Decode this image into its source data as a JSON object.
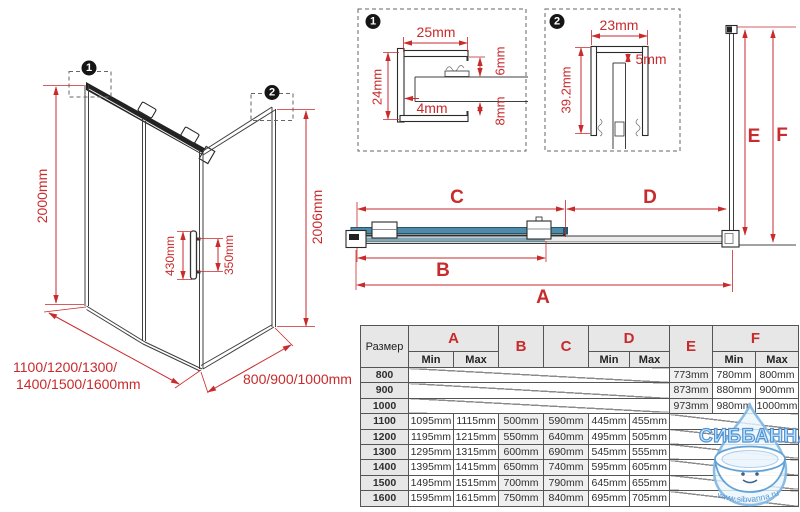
{
  "drawing": {
    "badge1": "1",
    "badge2": "2",
    "dim_height_left": "2000mm",
    "dim_handle_left": "430mm",
    "dim_handle_right": "350mm",
    "dim_height_right": "2006mm",
    "dim_width_front_line1": "1100/1200/1300/",
    "dim_width_front_line2": "1400/1500/1600mm",
    "dim_width_side": "800/900/1000mm"
  },
  "detail1": {
    "badge": "1",
    "dim_top": "25mm",
    "dim_left": "24mm",
    "dim_inner": "4mm",
    "dim_right_top": "6mm",
    "dim_right_bottom": "8mm"
  },
  "detail2": {
    "badge": "2",
    "dim_top": "23mm",
    "dim_gap": "5mm",
    "dim_left": "39.2mm"
  },
  "plan": {
    "label_a": "A",
    "label_b": "B",
    "label_c": "C",
    "label_d": "D",
    "label_e": "E",
    "label_f": "F"
  },
  "table": {
    "size_header": "Размер",
    "min_label": "Min",
    "max_label": "Max",
    "col_a": "A",
    "col_b": "B",
    "col_c": "C",
    "col_d": "D",
    "col_e": "E",
    "col_f": "F",
    "rows": [
      {
        "size": "800",
        "e": "773mm",
        "f_min": "780mm",
        "f_max": "800mm"
      },
      {
        "size": "900",
        "e": "873mm",
        "f_min": "880mm",
        "f_max": "900mm"
      },
      {
        "size": "1000",
        "e": "973mm",
        "f_min": "980mm",
        "f_max": "1000mm"
      },
      {
        "size": "1100",
        "a_min": "1095mm",
        "a_max": "1115mm",
        "b": "500mm",
        "c": "590mm",
        "d_min": "445mm",
        "d_max": "455mm"
      },
      {
        "size": "1200",
        "a_min": "1195mm",
        "a_max": "1215mm",
        "b": "550mm",
        "c": "640mm",
        "d_min": "495mm",
        "d_max": "505mm"
      },
      {
        "size": "1300",
        "a_min": "1295mm",
        "a_max": "1315mm",
        "b": "600mm",
        "c": "690mm",
        "d_min": "545mm",
        "d_max": "555mm"
      },
      {
        "size": "1400",
        "a_min": "1395mm",
        "a_max": "1415mm",
        "b": "650mm",
        "c": "740mm",
        "d_min": "595mm",
        "d_max": "605mm"
      },
      {
        "size": "1500",
        "a_min": "1495mm",
        "a_max": "1515mm",
        "b": "700mm",
        "c": "790mm",
        "d_min": "645mm",
        "d_max": "655mm"
      },
      {
        "size": "1600",
        "a_min": "1595mm",
        "a_max": "1615mm",
        "b": "750mm",
        "c": "840mm",
        "d_min": "695mm",
        "d_max": "705mm"
      }
    ]
  },
  "watermark": {
    "brand": "СИББАННА",
    "url": "www.sibvanna.ru"
  },
  "colors": {
    "dimension_red": "#c92a2c",
    "glass_blue": "#4e8ba8",
    "watermark_blue": "#4e94d6"
  }
}
